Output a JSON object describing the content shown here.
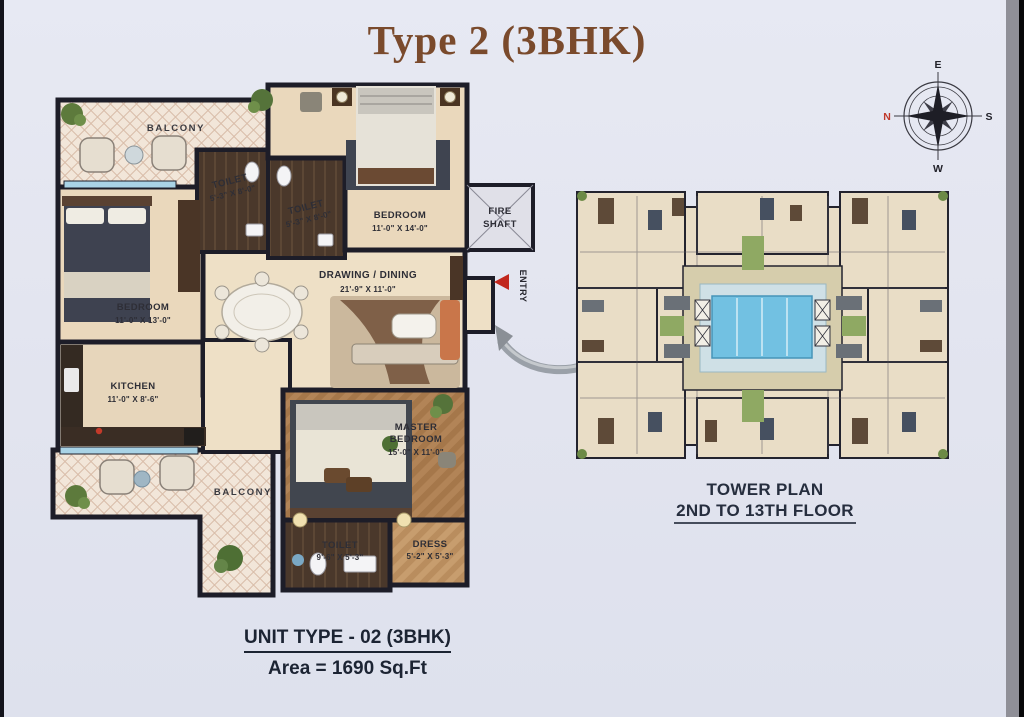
{
  "title": "Type 2 (3BHK)",
  "compass": {
    "east": "E",
    "south": "S",
    "west": "W",
    "north": "N"
  },
  "unit_plan": {
    "balcony_top": {
      "name": "BALCONY"
    },
    "balcony_bottom": {
      "name": "BALCONY"
    },
    "bedroom_left": {
      "name": "BEDROOM",
      "dims": "11'-0\" X 13'-0\""
    },
    "bedroom_top": {
      "name": "BEDROOM",
      "dims": "11'-0\" X 14'-0\""
    },
    "master_bedroom": {
      "name_line1": "MASTER",
      "name_line2": "BEDROOM",
      "dims": "15'-0\" X 11'-0\""
    },
    "toilet_1": {
      "name": "TOILET",
      "dims": "5'-3\" X 8'-0\""
    },
    "toilet_2": {
      "name": "TOILET",
      "dims": "5'-3\" X 8'-0\""
    },
    "toilet_master": {
      "name": "TOILET",
      "dims": "9'-6\" X 5'-3\""
    },
    "dress": {
      "name": "DRESS",
      "dims": "5'-2\" X 5'-3\""
    },
    "kitchen": {
      "name": "KITCHEN",
      "dims": "11'-0\" X 8'-6\""
    },
    "drawing_dining": {
      "name": "DRAWING / DINING",
      "dims": "21'-9\" X 11'-0\""
    },
    "fire_shaft": {
      "line1": "FIRE",
      "line2": "SHAFT"
    },
    "entry": {
      "label": "ENTRY"
    }
  },
  "tower_plan": {
    "caption_line1": "TOWER PLAN",
    "caption_line2": "2ND TO 13TH FLOOR"
  },
  "footer": {
    "unit_type": "UNIT TYPE - 02 (3BHK)",
    "area": "Area = 1690 Sq.Ft"
  },
  "colors": {
    "title_text": "#7a4a2c",
    "footer_text": "#1c2433",
    "wall": "#1d1d28",
    "entry_arrow_red": "#c1271d",
    "pool_blue": "#72c1e2",
    "compass_north_red": "#c0392b"
  }
}
